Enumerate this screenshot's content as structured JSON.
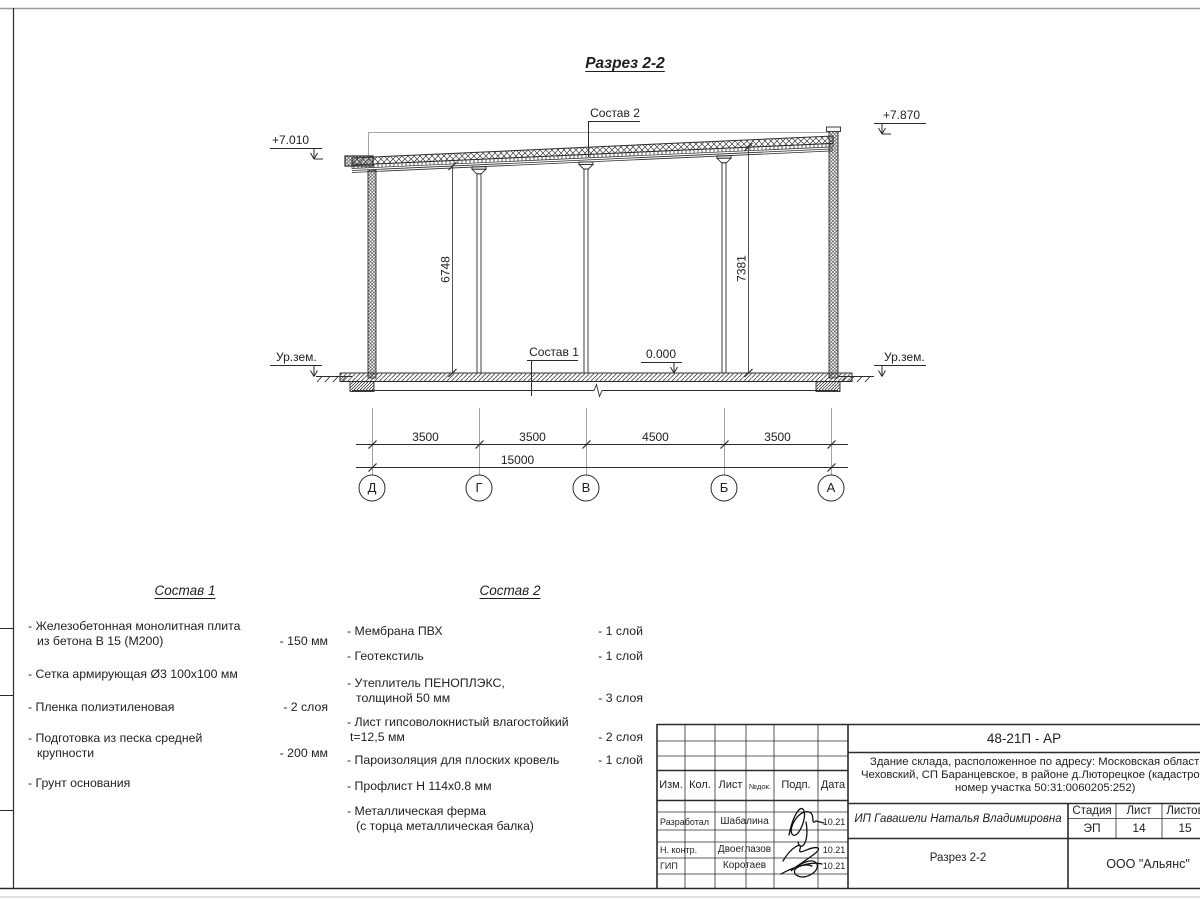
{
  "drawing": {
    "title": "Разрез 2-2",
    "elev_left": "+7.010",
    "elev_right": "+7.870",
    "elev_zero": "0.000",
    "ground_left": "Ур.зем.",
    "ground_right": "Ур.зем.",
    "leader_sostav1": "Состав 1",
    "leader_sostav2": "Состав 2",
    "vdim_left": "6748",
    "vdim_right": "7381",
    "axis_dims": [
      "3500",
      "3500",
      "4500",
      "3500"
    ],
    "total_dim": "15000",
    "axes": [
      "Д",
      "Г",
      "В",
      "Б",
      "А"
    ]
  },
  "sostav1": {
    "title": "Состав 1",
    "items": [
      {
        "line1": "- Железобетонная  монолитная плита",
        "line2": "из бетона В 15 (М200)",
        "value": "- 150 мм"
      },
      {
        "line1": "- Сетка армирующая Ø3 100х100 мм",
        "line2": "",
        "value": ""
      },
      {
        "line1": "- Пленка полиэтиленовая",
        "line2": "",
        "value": "-  2 слоя"
      },
      {
        "line1": "- Подготовка из песка средней",
        "line2": "крупности",
        "value": "- 200 мм"
      },
      {
        "line1": "- Грунт основания",
        "line2": "",
        "value": ""
      }
    ]
  },
  "sostav2": {
    "title": "Состав 2",
    "items": [
      {
        "line1": "- Мембрана ПВХ",
        "line2": "",
        "value": "- 1 слой"
      },
      {
        "line1": "- Геотекстиль",
        "line2": "",
        "value": "- 1 слой"
      },
      {
        "line1": "- Утеплитель ПЕНОПЛЭКС,",
        "line2": "толщиной 50 мм",
        "value": "- 3 слоя"
      },
      {
        "line1": "- Лист гипсоволокнистый влагостойкий",
        "line2": "t=12,5 мм",
        "value": "- 2 слоя"
      },
      {
        "line1": "- Пароизоляция для плоских кровель",
        "line2": "",
        "value": "- 1 слой"
      },
      {
        "line1": "- Профлист Н 114х0.8 мм",
        "line2": "",
        "value": ""
      },
      {
        "line1": "- Металлическая ферма",
        "line2": "(с торца металлическая балка)",
        "value": ""
      }
    ]
  },
  "titleblock": {
    "code": "48-21П - АР",
    "desc_line1": "Здание склада, расположенное по адресу: Московская область, р",
    "desc_line2": "Чеховский, СП Баранцевское, в районе д.Люторецкое  (кадастровы",
    "desc_line3": "номер участка 50:31:0060205:252)",
    "client": "ИП Гавашели Наталья Владимировна",
    "sheet_title": "Разрез 2-2",
    "company": "ООО \"Альянс\"",
    "col_izm": "Изм.",
    "col_kol": "Кол.",
    "col_list": "Лист",
    "col_ndok": "№док.",
    "col_podp": "Подп.",
    "col_data": "Дата",
    "stage_label": "Стадия",
    "sheet_label": "Лист",
    "sheets_label": "Листов",
    "stage": "ЭП",
    "sheet_num": "14",
    "sheets_total": "15",
    "rows": [
      {
        "role": "Разработал",
        "name": "Шабалина",
        "date": "10.21"
      },
      {
        "role": "Н. контр.",
        "name": "Двоеглазов",
        "date": "10.21"
      },
      {
        "role": "ГИП",
        "name": "Коротаев",
        "date": "10.21"
      }
    ]
  }
}
